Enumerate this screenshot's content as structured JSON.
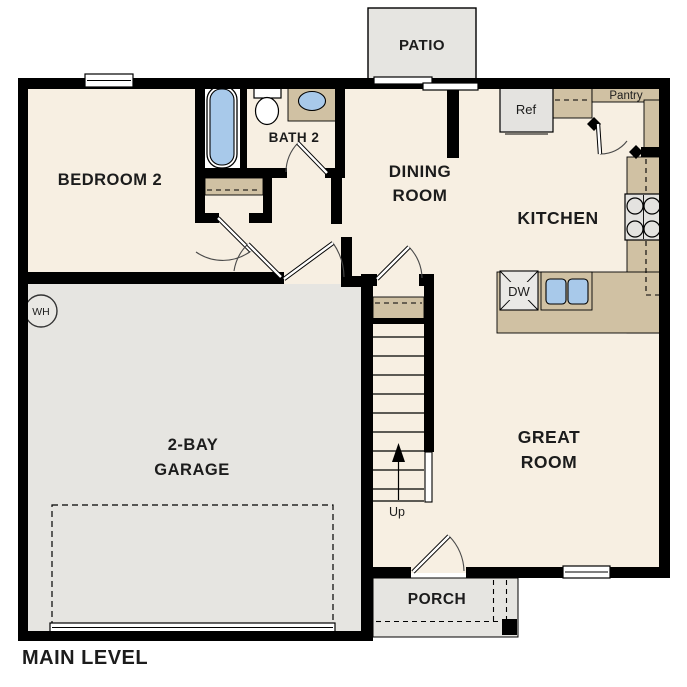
{
  "plan": {
    "level_label": "MAIN LEVEL",
    "rooms": {
      "bedroom2": {
        "label": "BEDROOM 2"
      },
      "bath2": {
        "label": "BATH 2"
      },
      "dining": {
        "line1": "DINING",
        "line2": "ROOM"
      },
      "kitchen": {
        "label": "KITCHEN"
      },
      "great_room": {
        "line1": "GREAT",
        "line2": "ROOM"
      },
      "garage": {
        "line1": "2-BAY",
        "line2": "GARAGE"
      },
      "porch": {
        "label": "PORCH"
      },
      "patio": {
        "label": "PATIO"
      },
      "pantry": {
        "label": "Pantry"
      }
    },
    "fixtures": {
      "refrigerator": "Ref",
      "dishwasher": "DW",
      "water_heater": "WH",
      "stairs_direction": "Up"
    }
  },
  "colors": {
    "floor": "#F7EFE2",
    "garage": "#E6E5E1",
    "counter": "#D0C1A3",
    "fixture_blue": "#A8C9EA",
    "appliance": "#E4E3E0",
    "wall": "#000000",
    "text": "#1C1C1C"
  }
}
